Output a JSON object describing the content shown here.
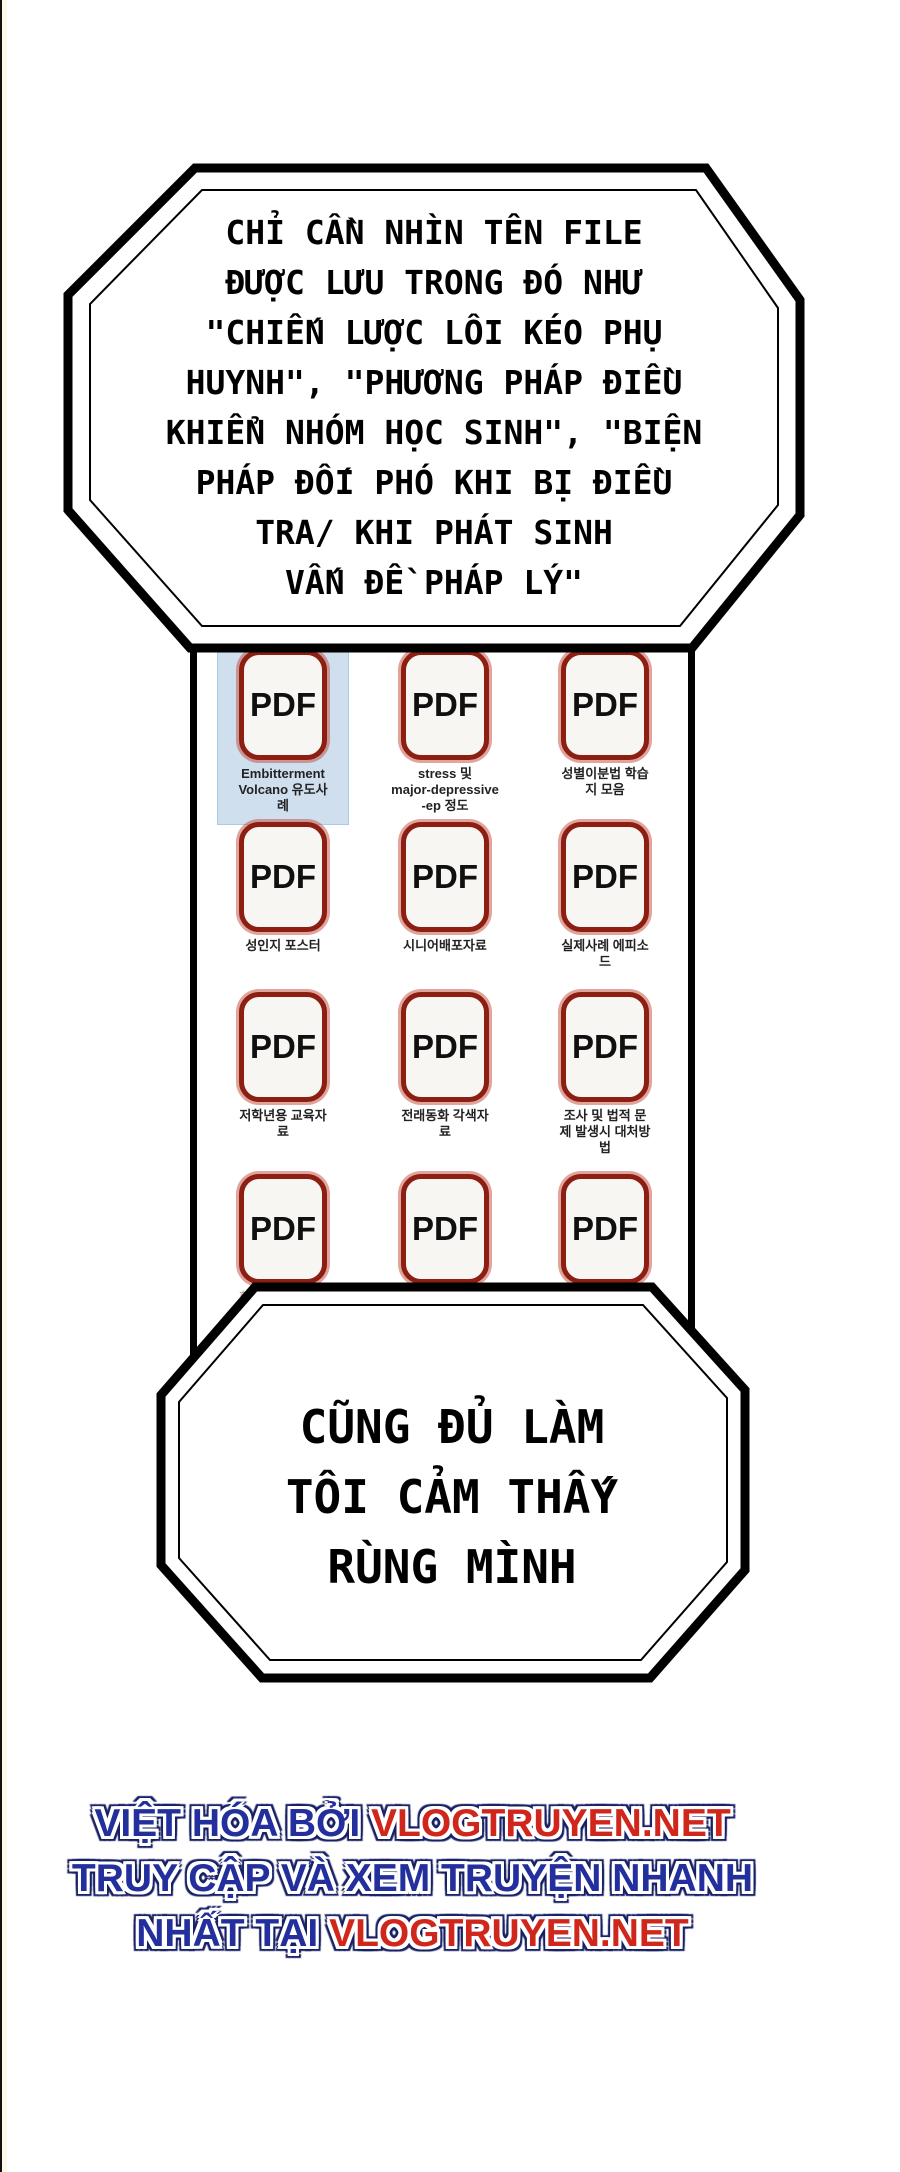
{
  "top_bubble": {
    "lines": [
      "CHỈ CẦN NHÌN TÊN FILE",
      "ĐƯỢC LƯU TRONG ĐÓ NHƯ",
      "\"CHIẾN LƯỢC LÔI KÉO PHỤ",
      "HUYNH\", \"PHƯƠNG PHÁP ĐIỀU",
      "KHIỂN NHÓM HỌC SINH\", \"BIỆN",
      "PHÁP ĐỐI PHÓ KHI BỊ ĐIỀU",
      "TRA/ KHI PHÁT SINH",
      "VẤN ĐỀ PHÁP LÝ\""
    ]
  },
  "bottom_bubble": {
    "lines": [
      "CŨNG ĐỦ LÀM",
      "TÔI CẢM THẤY",
      "RÙNG MÌNH"
    ]
  },
  "file_grid": {
    "pdf_label": "PDF",
    "items": [
      {
        "caption": "Embitterment\nVolcano 유도사\n례",
        "selected": true
      },
      {
        "caption": "stress 및\nmajor-depressive\n-ep 정도"
      },
      {
        "caption": "성별이분법 학습\n지 모음"
      },
      {
        "caption": "성인지 포스터"
      },
      {
        "caption": "시니어배포자료"
      },
      {
        "caption": "실제사례 에피소\n드"
      },
      {
        "caption": "저학년용 교육자\n료"
      },
      {
        "caption": "전래동화 각색자\n료"
      },
      {
        "caption": "조사 및 법적 문\n제 발생시 대처방\n법"
      },
      {
        "caption": "학부모 포섭전략",
        "faded": true
      },
      {
        "caption": "학생군집고립율",
        "faded": true
      },
      {
        "caption": "활동비청구서(안",
        "faded": true
      }
    ]
  },
  "watermark": {
    "line1_blue": "VIỆT HÓA BỞI ",
    "line1_red": "VLOGTRUYEN.NET",
    "line2_blue": "TRUY CẬP VÀ XEM TRUYỆN NHANH",
    "line3_blue": "NHẤT TẠI ",
    "line3_red": "VLOGTRUYEN.NET"
  },
  "colors": {
    "pdf_border": "#8c1e12",
    "selection_bg": "#cfdfee",
    "watermark_blue": "#222f9d",
    "watermark_red": "#d0271c"
  }
}
